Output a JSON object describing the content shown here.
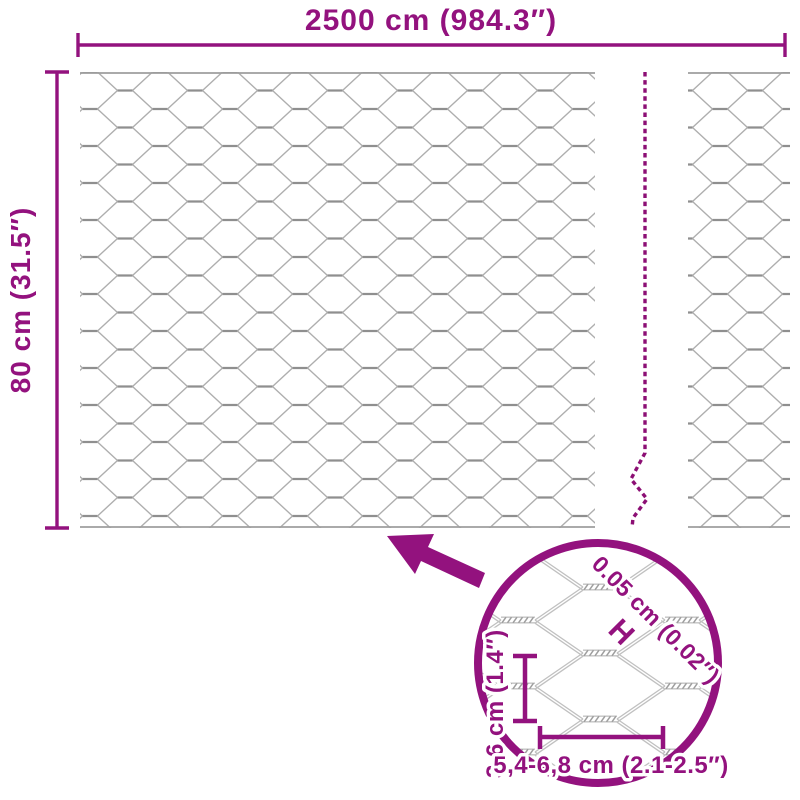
{
  "page": {
    "background": "#ffffff"
  },
  "colors": {
    "accent": "#93127e",
    "dash": "#8c0f74",
    "wire_light": "#aeaeae",
    "wire_dark": "#8f8f8f",
    "zoom_wire": "#c0c0c0",
    "zoom_twist": "#9e9e9e"
  },
  "diagram": {
    "width_dimension": {
      "label": "2500 cm (984.3″)"
    },
    "height_dimension": {
      "label": "80 cm (31.5″)"
    },
    "detail": {
      "wire_thickness_label": "0.05 cm (0.02″)",
      "wire_thickness_symbol": "H",
      "mesh_height_label": "3,6 cm (1.4″)",
      "mesh_width_label": "5,4-6,8 cm (2.1-2.5″)"
    }
  }
}
